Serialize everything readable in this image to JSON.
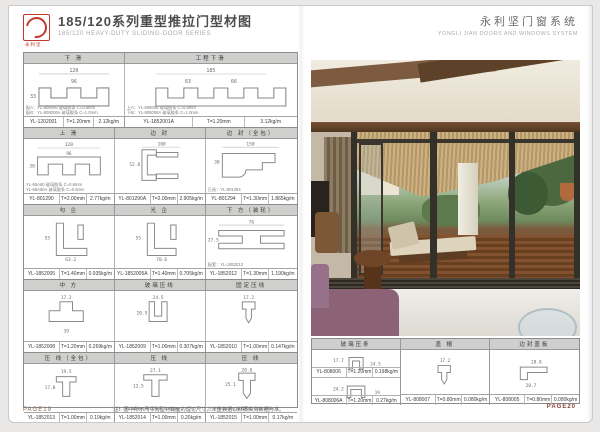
{
  "left_page": {
    "logo_label": "永利坚",
    "title": "185/120系列重型推拉门型材图",
    "subtitle": "185/120 HEAVY-DUTY SLIDING-DOOR SERIES",
    "footer_page": "PAGE19",
    "bottom_note": "注：图中所示尺寸为型材截面的理论尺寸，米重数据以材质实测数据为准。"
  },
  "right_page": {
    "title": "永利坚门窗系统",
    "subtitle": "YONGLI JIAN DOORS AND WINDOWS SYSTEM",
    "footer_page": "PAGE20",
    "photo_caption": "重型推拉门实景：客房推拉门敞开通往海景木平台"
  },
  "colors": {
    "logo_red": "#c0392b",
    "band_header_gray": "#cfcfcd",
    "table_border": "#8d8d8d",
    "photo_wood": "#6b4a2f",
    "photo_thatch": "#c3a87c",
    "photo_sofa_purple": "#8c6277"
  },
  "bands": [
    {
      "headers": [
        "下 滑",
        "工程下滑"
      ],
      "cells": [
        {
          "model": "YL-1202001",
          "thickness": "T=1.20mm",
          "weight": "2.12kg/m",
          "dims": [
            "120",
            "96",
            "33"
          ],
          "notes": [
            "配A：YL-808006 玻璃胶条 C=0.8mm",
            "配B：YL-808006A 玻璃胶条 C=1.0mm"
          ]
        },
        {
          "model": "YL-1852001A",
          "thickness": "T=1.20mm",
          "weight": "3.12kg/m",
          "dims": [
            "185",
            "63",
            "66"
          ],
          "notes": [
            "上A：YL-808008 玻璃胶条 C=0.8mm",
            "下B：YL-808008A 玻璃胶条 C=1.0mm"
          ]
        }
      ]
    },
    {
      "headers": [
        "上 滑",
        "边 封",
        "边 封（全包）"
      ],
      "cells": [
        {
          "model": "YL-801290",
          "thickness": "T=2.00mm",
          "weight": "2.77kg/m",
          "dims": [
            "120",
            "96",
            "30"
          ],
          "notes": [
            "YL-65A60 玻璃胶条 C=0.8mm",
            "YL-65A60A 玻璃胶条 C=0.5mm"
          ]
        },
        {
          "model": "YL-801290A",
          "thickness": "T=2.00mm",
          "weight": "2.905kg/m",
          "dims": [
            "100",
            "52.8"
          ],
          "notes": [
            "",
            ""
          ]
        },
        {
          "model": "YL-801294",
          "thickness": "T=1.30mm",
          "weight": "1.865kg/m",
          "dims": [
            "150",
            "30"
          ],
          "notes": [
            "已选：YL-801294",
            ""
          ]
        }
      ]
    },
    {
      "headers": [
        "勾 企",
        "光 企",
        "下 方（装轮）"
      ],
      "cells": [
        {
          "model": "YL-1852005",
          "thickness": "T=1.40mm",
          "weight": "0.935kg/m",
          "dims": [
            "63.2",
            "55"
          ],
          "notes": [
            "",
            ""
          ]
        },
        {
          "model": "YL-1852005A",
          "thickness": "T=1.40mm",
          "weight": "0.705kg/m",
          "dims": [
            "70.6",
            "55"
          ],
          "notes": [
            "",
            ""
          ]
        },
        {
          "model": "YL-1852012",
          "thickness": "T=1.30mm",
          "weight": "1.190kg/m",
          "dims": [
            "76",
            "27.5"
          ],
          "notes": [
            "配套：YL-1852012",
            ""
          ]
        }
      ]
    },
    {
      "headers": [
        "中 方",
        "玻璃压线",
        "固定压线"
      ],
      "cells": [
        {
          "model": "YL-1852008",
          "thickness": "T=1.20mm",
          "weight": "0.269kg/m",
          "dims": [
            "17.2",
            "39"
          ],
          "notes": [
            "",
            ""
          ]
        },
        {
          "model": "YL-1852009",
          "thickness": "T=1.00mm",
          "weight": "0.307kg/m",
          "dims": [
            "24.5",
            "20.5"
          ],
          "notes": [
            "",
            ""
          ]
        },
        {
          "model": "YL-1852010",
          "thickness": "T=1.00mm",
          "weight": "0.147kg/m",
          "dims": [
            "17.2",
            ""
          ],
          "notes": [
            "",
            ""
          ]
        }
      ]
    },
    {
      "headers": [
        "压 线（全包）",
        "压 线",
        "压 线"
      ],
      "cells": [
        {
          "model": "YL-1852013",
          "thickness": "T=1.00mm",
          "weight": "0.19kg/m",
          "dims": [
            "19.5",
            "17.8"
          ],
          "notes": [
            "",
            ""
          ]
        },
        {
          "model": "YL-1852014",
          "thickness": "T=1.00mm",
          "weight": "0.20kg/m",
          "dims": [
            "27.1",
            "12.5"
          ],
          "notes": [
            "注：YL-80/500 玻璃胶条 C=4mm",
            ""
          ]
        },
        {
          "model": "YL-1852015",
          "thickness": "T=1.00mm",
          "weight": "0.17kg/m",
          "dims": [
            "20.6",
            "25.1"
          ],
          "notes": [
            "注：YL-80/707 玻璃胶条 C=0.5mm",
            ""
          ]
        }
      ]
    },
    {
      "headers": [
        "玻璃压条",
        "盖 帽",
        "边封盖板"
      ],
      "cells": [
        {
          "model": "YL-808006",
          "thickness": "T=1.20mm",
          "weight": "0.198kg/m",
          "dims": [
            "17.7",
            "24.5"
          ]
        },
        {
          "model": "YL-808006A",
          "thickness": "T=1.20mm",
          "weight": "0.27kg/m",
          "dims": [
            "24.2",
            "19"
          ]
        },
        {
          "model": "YL-808007",
          "thickness": "T=0.80mm",
          "weight": "0.080kg/m",
          "dims": [
            "17.2",
            ""
          ]
        },
        {
          "model": "YL-808005",
          "thickness": "T=0.80mm",
          "weight": "0.080kg/m",
          "dims": [
            "28.8",
            "20.7"
          ]
        }
      ]
    }
  ]
}
